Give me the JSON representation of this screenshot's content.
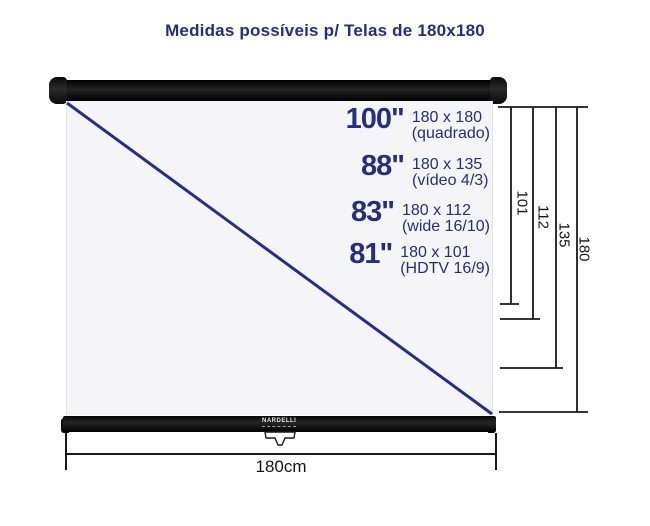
{
  "title": "Medidas possíveis p/ Telas de 180x180",
  "diagram": {
    "brand": "NARDELLI",
    "width_label": "180cm",
    "sizes": [
      {
        "inches": "100\"",
        "dimensions": "180 x 180",
        "format": "(quadrado)"
      },
      {
        "inches": "88\"",
        "dimensions": "180 x 135",
        "format": "(vídeo 4/3)"
      },
      {
        "inches": "83\"",
        "dimensions": "180 x 112",
        "format": "(wide 16/10)"
      },
      {
        "inches": "81\"",
        "dimensions": "180 x 101",
        "format": "(HDTV 16/9)"
      }
    ],
    "height_markers": [
      "101",
      "112",
      "135",
      "180"
    ]
  },
  "colors": {
    "accent_navy": "#252e7f",
    "diagonal_blue": "#252e8c",
    "line_black": "#1a1a1a"
  }
}
